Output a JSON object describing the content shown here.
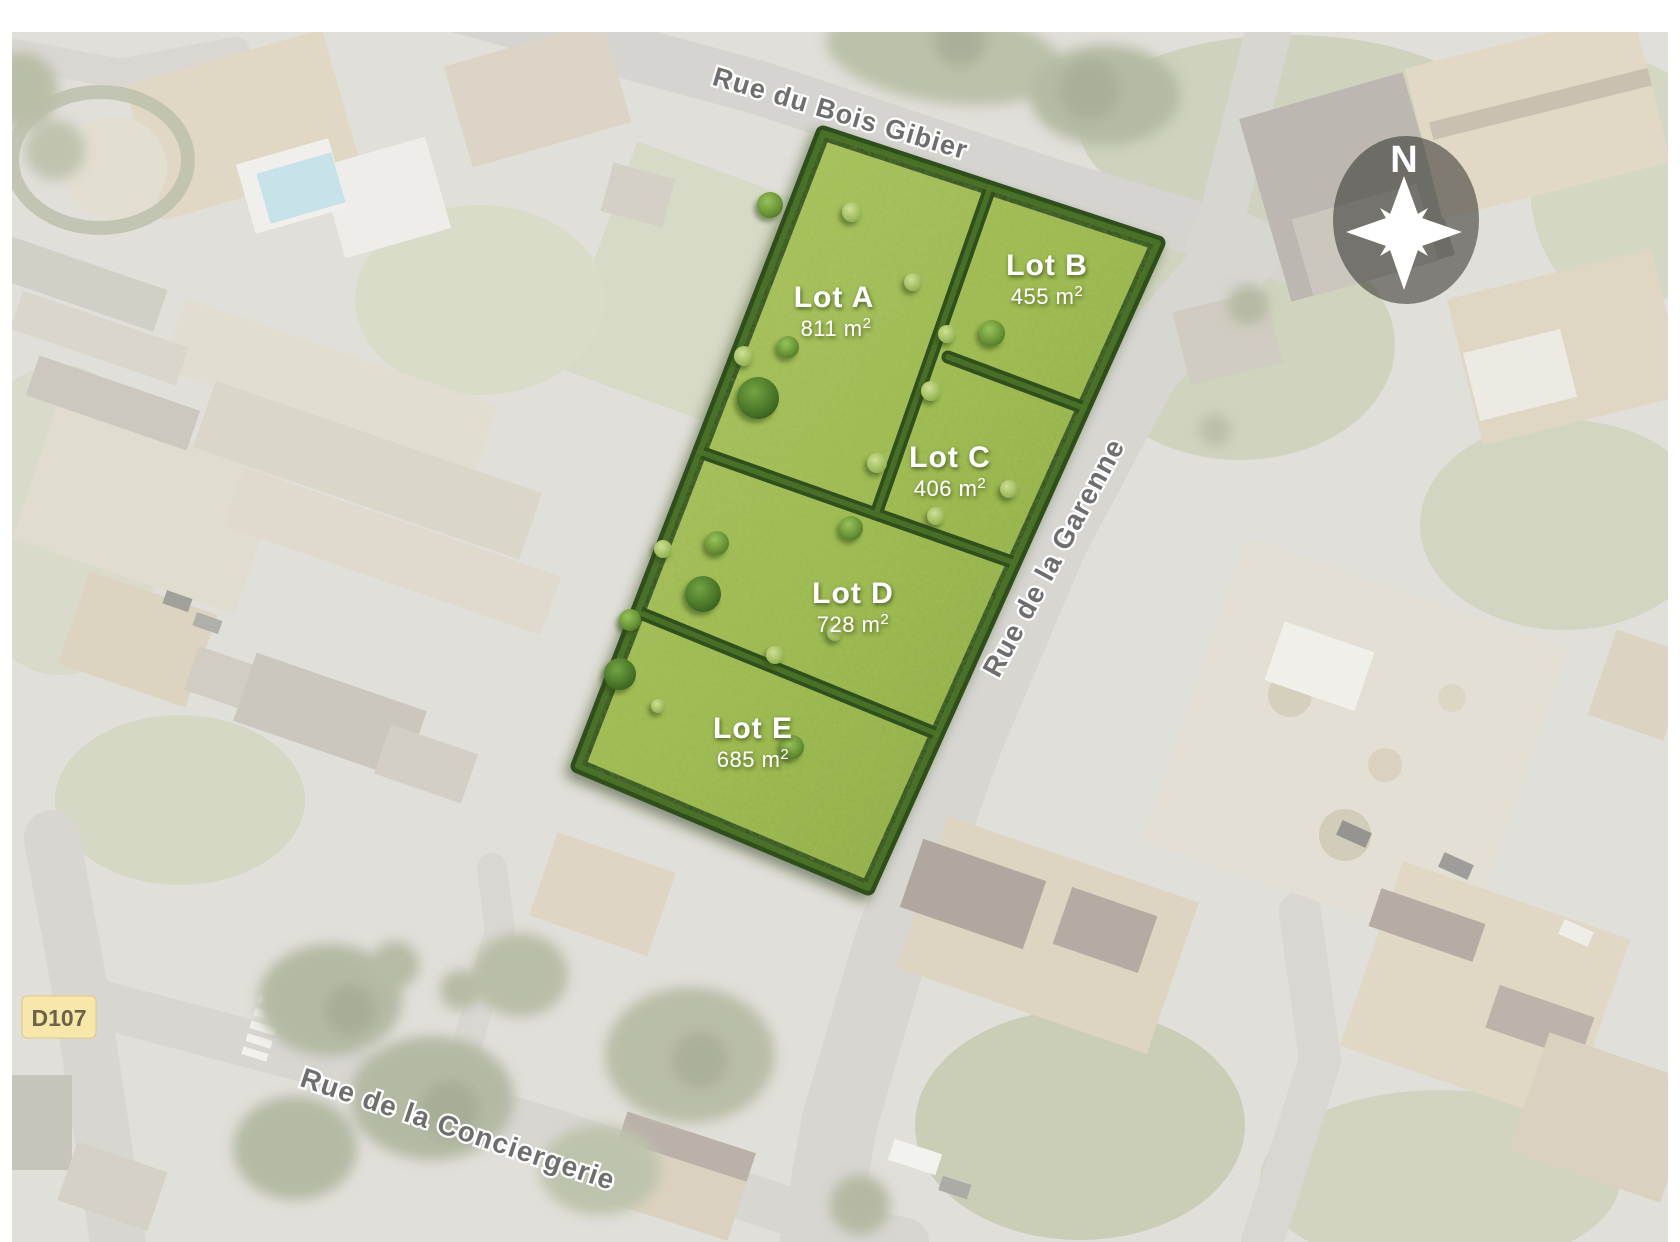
{
  "streets": {
    "bois_gibier": "Rue du Bois Gibier",
    "garenne": "Rue de la Garenne",
    "conciergerie": "Rue de la Conciergerie"
  },
  "road_badge": {
    "label": "D107"
  },
  "compass": {
    "north": "N"
  },
  "lots": [
    {
      "id": "A",
      "name": "Lot A",
      "area_main": "811 m",
      "area_sup": "2"
    },
    {
      "id": "B",
      "name": "Lot B",
      "area_main": "455 m",
      "area_sup": "2"
    },
    {
      "id": "C",
      "name": "Lot C",
      "area_main": "406 m",
      "area_sup": "2"
    },
    {
      "id": "D",
      "name": "Lot D",
      "area_main": "728 m",
      "area_sup": "2"
    },
    {
      "id": "E",
      "name": "Lot E",
      "area_main": "685 m",
      "area_sup": "2"
    }
  ],
  "colors": {
    "lot_grass": "#9bb84d",
    "hedge_green": "#2f4f1c",
    "lot_label_text": "#ffffff",
    "street_label": "#6e6e6e",
    "badge_bg": "#f7e7ab",
    "badge_text": "#6c6349",
    "road": "#c9c7c1",
    "pool_blue": "#b3d7e1"
  }
}
